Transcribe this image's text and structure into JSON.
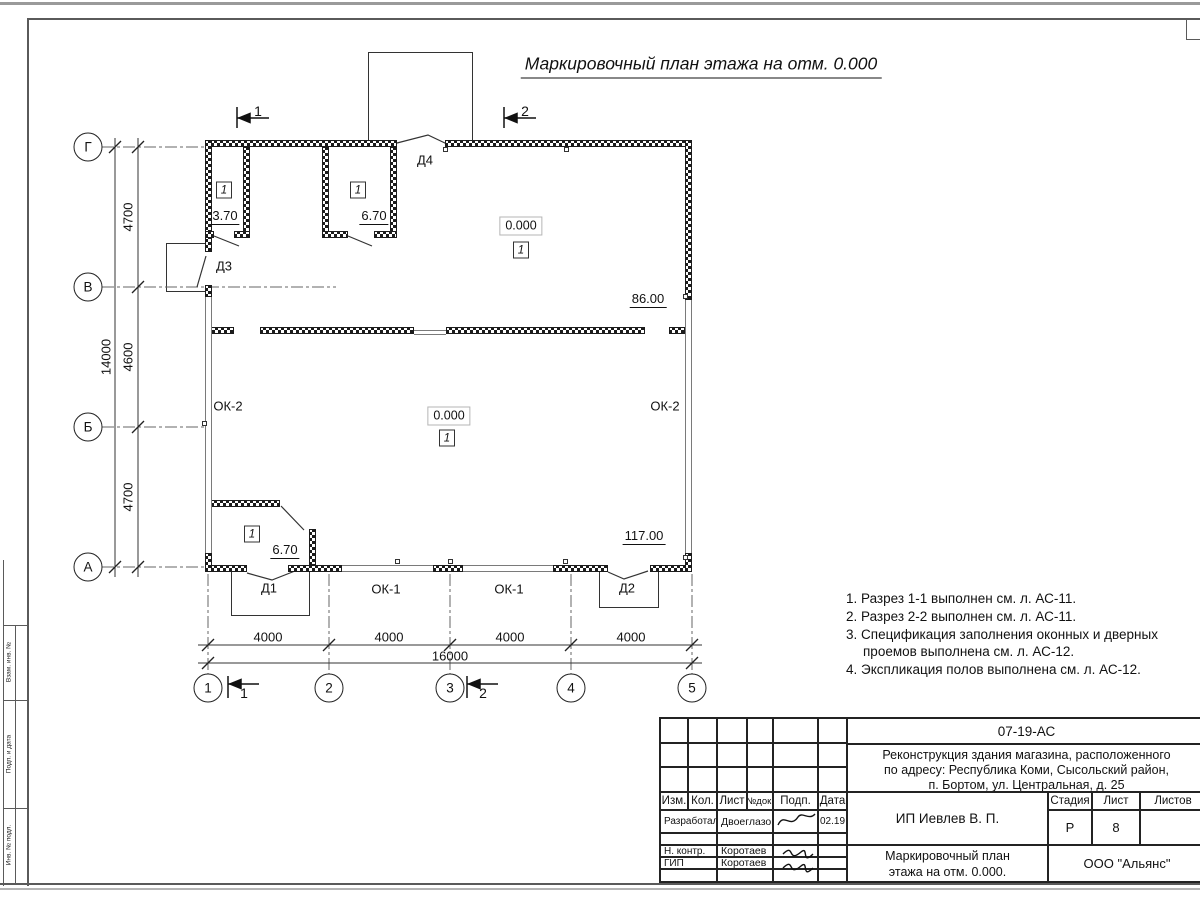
{
  "sheet_title": "Маркировочный план этажа на отм. 0.000",
  "plan": {
    "axes_bottom": [
      "1",
      "2",
      "3",
      "4",
      "5"
    ],
    "axes_left": [
      "Г",
      "В",
      "Б",
      "А"
    ],
    "dims_bottom": [
      "4000",
      "4000",
      "4000",
      "4000"
    ],
    "dim_bottom_total": "16000",
    "dims_left": [
      "4700",
      "4600",
      "4700"
    ],
    "dim_left_total": "14000",
    "sections": {
      "s1": "1",
      "s2": "2"
    },
    "doors": {
      "d1": "Д1",
      "d2": "Д2",
      "d3": "Д3",
      "d4": "Д4"
    },
    "windows": {
      "ok1": "ОК-1",
      "ok2": "ОК-2"
    },
    "rooms": {
      "room_370": {
        "num": "1",
        "area": "3.70"
      },
      "room_670_top": {
        "num": "1",
        "area": "6.70"
      },
      "hall_top": {
        "num": "1",
        "elev": "0.000",
        "area": "86.00"
      },
      "hall_bottom": {
        "num": "1",
        "elev": "0.000",
        "area": "117.00"
      },
      "room_670_bottom": {
        "num": "1",
        "area": "6.70"
      }
    }
  },
  "notes": [
    "1. Разрез 1-1 выполнен см. л. АС-11.",
    "2. Разрез 2-2 выполнен см. л. АС-11.",
    "3. Спецификация заполнения оконных и дверных проемов выполнена см. л. АС-12.",
    "4. Экспликация полов выполнена см. л. АС-12."
  ],
  "titleblock": {
    "doc_code": "07-19-АС",
    "project_lines": [
      "Реконструкция здания магазина, расположенного",
      "по адресу: Республика Коми, Сысольский район,",
      "п. Бортом, ул. Центральная, д. 25"
    ],
    "client": "ИП Иевлев В. П.",
    "title_lines": [
      "Маркировочный план",
      "этажа на отм. 0.000."
    ],
    "company": "ООО \"Альянс\"",
    "cols": {
      "izm": "Изм.",
      "kol": "Кол.",
      "list": "Лист",
      "ndok": "№док.",
      "podp": "Подп.",
      "data": "Дата"
    },
    "stage_label": "Стадия",
    "sheet_label": "Лист",
    "sheets_label": "Листов",
    "stage": "Р",
    "sheet_no": "8",
    "rows": [
      {
        "role": "Разработал",
        "name": "Двоеглазов",
        "date": "02.19"
      },
      {
        "role": "Н. контр.",
        "name": "Коротаев",
        "date": ""
      },
      {
        "role": "ГИП",
        "name": "Коротаев",
        "date": ""
      }
    ]
  },
  "frame_left": [
    "Взам. инв. №",
    "Подп. и дата",
    "Инв. № подл."
  ]
}
